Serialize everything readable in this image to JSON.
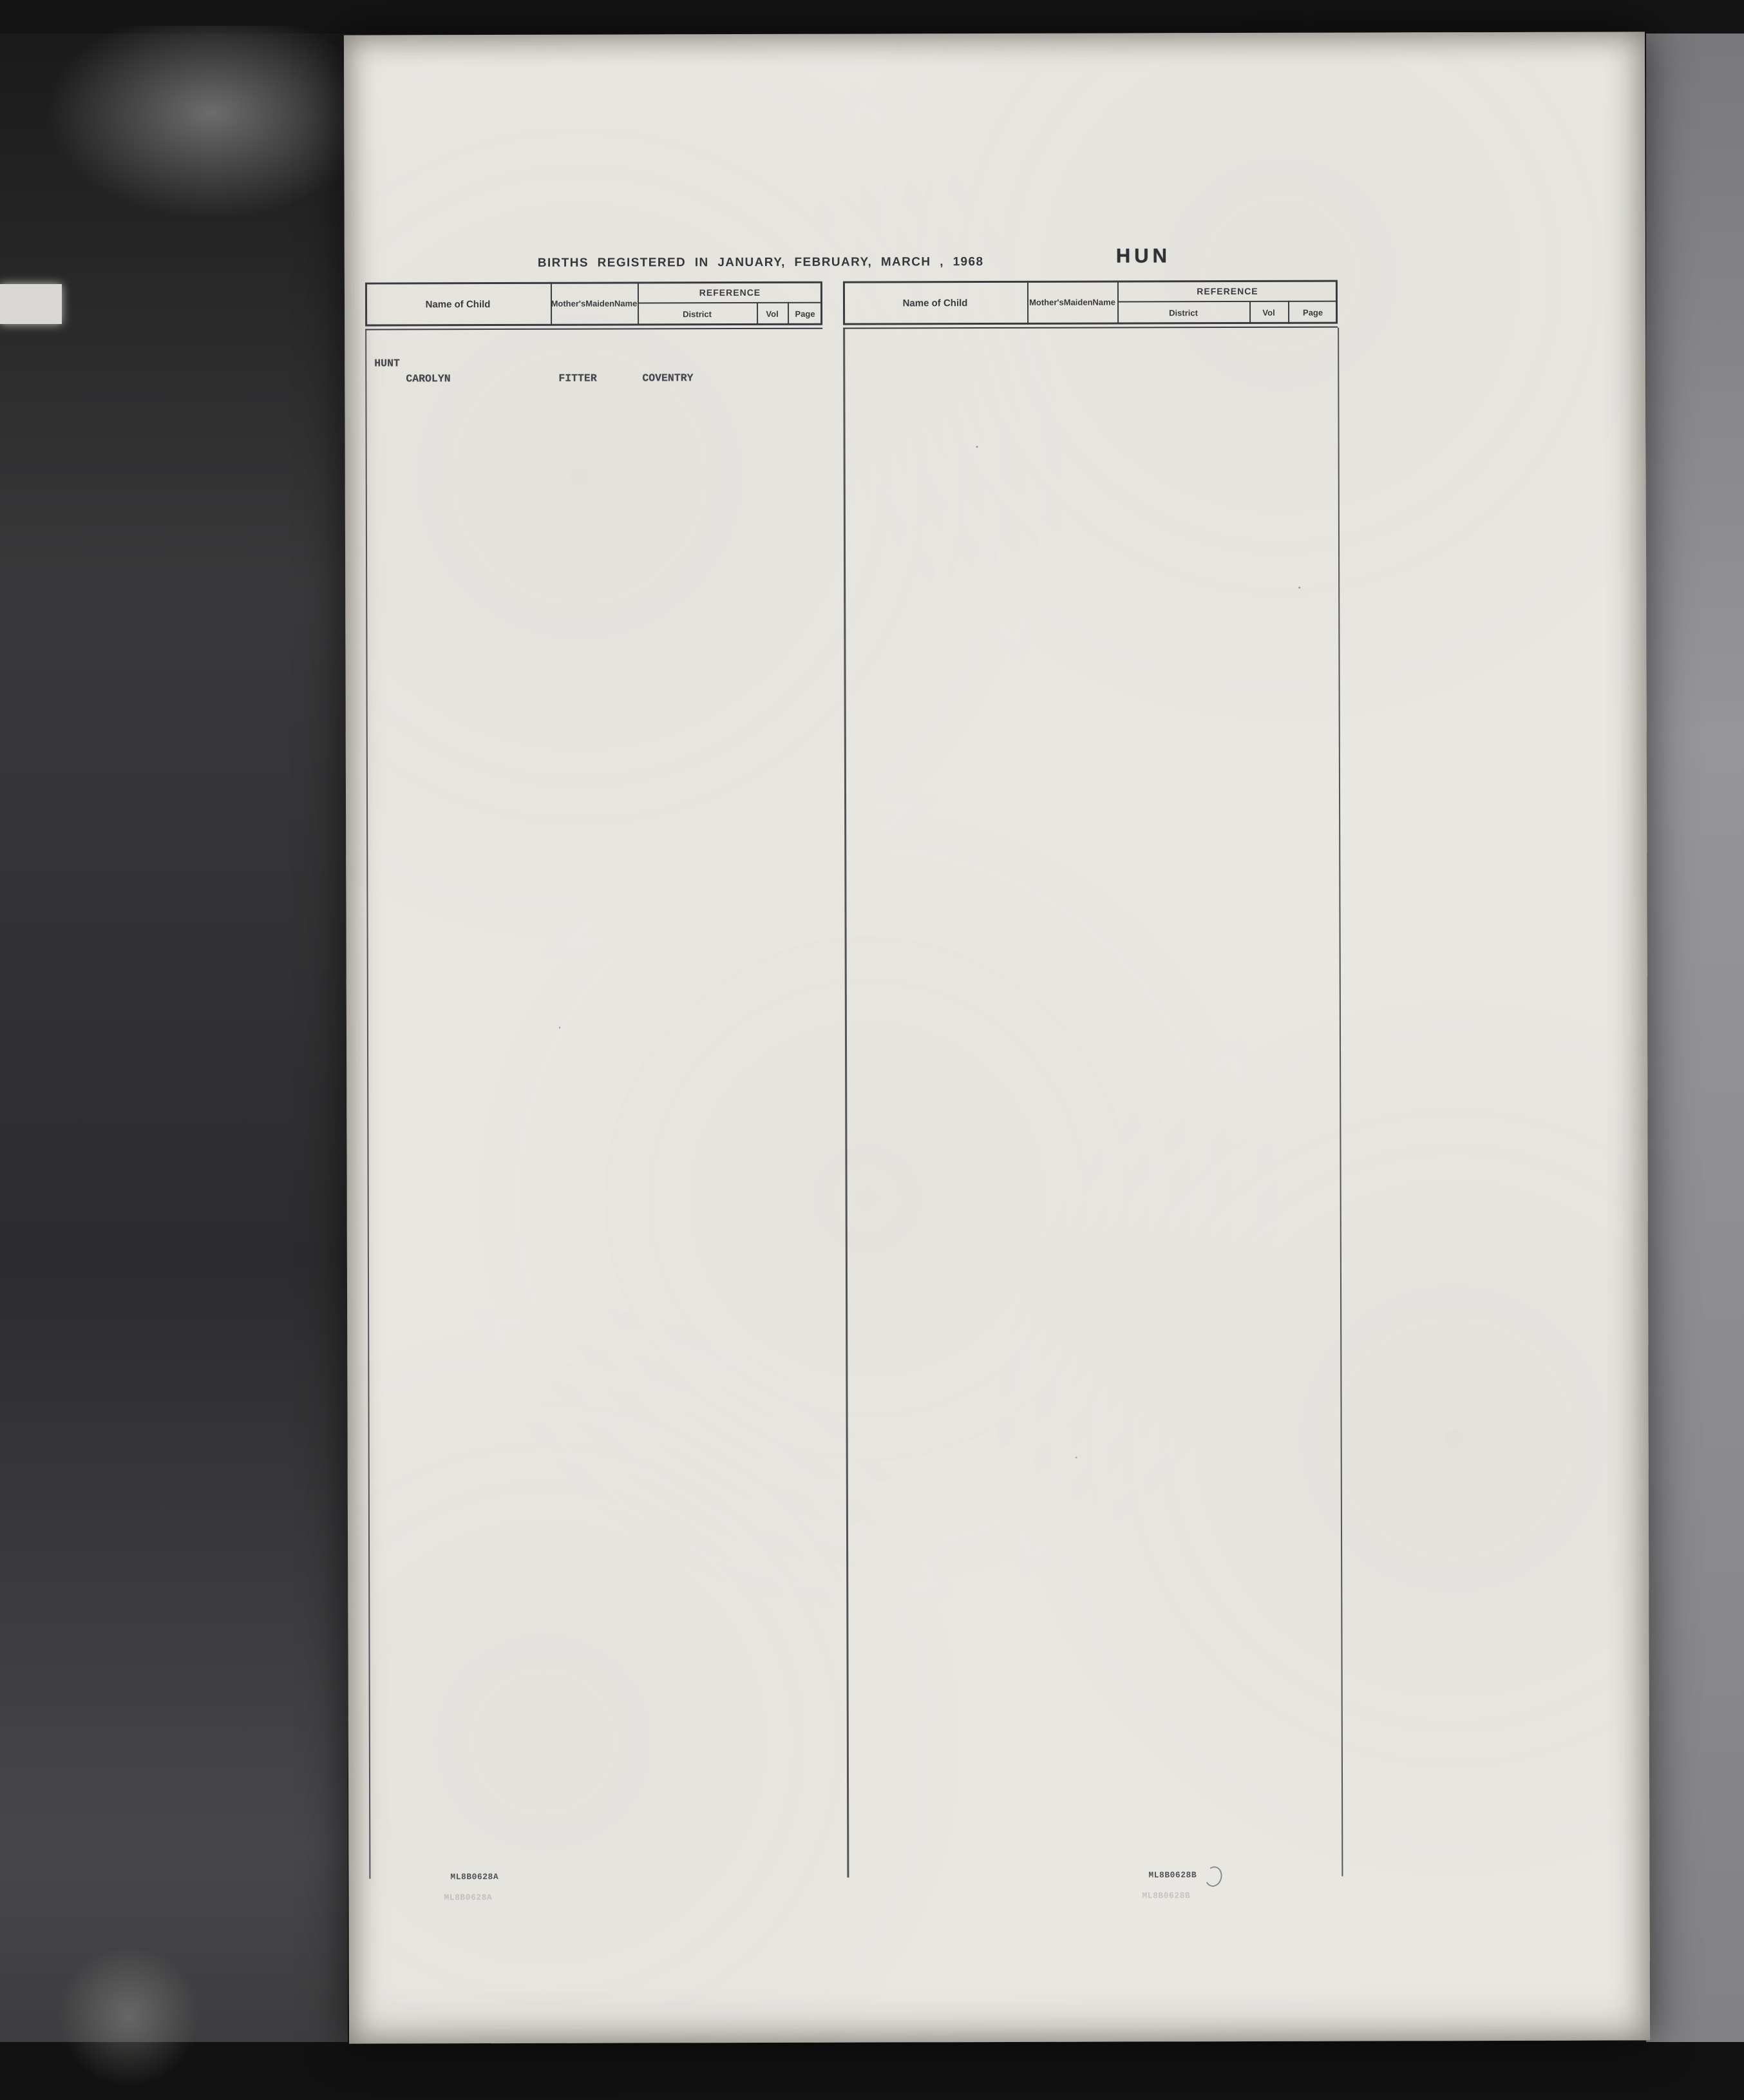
{
  "header": {
    "title": "BIRTHS REGISTERED IN JANUARY, FEBRUARY, MARCH , 1968",
    "section_code": "HUN",
    "col_name": "Name of Child",
    "col_mother_1": "Mother's",
    "col_mother_2": "Maiden",
    "col_mother_3": "Name",
    "col_reference": "REFERENCE",
    "col_district": "District",
    "col_vol": "Vol",
    "col_page": "Page"
  },
  "surname_left": "HUNT",
  "surname_right": "HUNT",
  "stamps": {
    "left": "ML8B0628A",
    "right": "ML8B0628B"
  },
  "footnotes_left": {
    "vol_note": "3c",
    "scribble": "372"
  },
  "left_groups": [
    [
      [
        "CAROLYN",
        "FITTER",
        "COVENTRY",
        "9C1344"
      ],
      [
        "CATHERINE ANN",
        "DIAMOND",
        "ROCHFORD",
        "4A1620"
      ],
      [
        "CATHERINE MARY",
        "TINDALL",
        "DON VALLEY",
        "2B 834"
      ],
      [
        "CELIA RUTH",
        "IVIN",
        "BEXLEY",
        "5A 334"
      ],
      [
        "CHERYL ANN",
        "CLEGG",
        "LEIGH",
        "10D  46"
      ],
      [
        "CHRISTINE MARGARET",
        "CADY",
        "THANET",
        "5F1042"
      ],
      [
        "CHRISTINE MARIE",
        "FOLAN",
        "BARTON",
        "10B 377"
      ],
      [
        "CHRISTOPHER CHARLES",
        "BENNETT",
        "WARRINGTON",
        "10F1062"
      ],
      [
        "CHRISTOPHER JOHN",
        "LAMONT",
        "WINCHESTER",
        "6B1345"
      ],
      [
        "CLAIR",
        "PONIFACE",
        "EASTBOURNE",
        "5H 346"
      ]
    ],
    [
      [
        "CLAIPE LOUISE",
        "MORKOT",
        "SWINDON",
        "7C1093"
      ],
      [
        "CLARE ROSEMARY",
        "YALLUP",
        "NUNEATON",
        "9C1744"
      ],
      [
        "CLIVE CHARLES",
        "HUNT",
        "NOTTINGHAM",
        "3C 707"
      ],
      [
        "COLETTE AISLING",
        "O'CONNOR",
        "MERTON",
        "5D 580S"
      ],
      [
        "COLIN DAVID",
        "RANDALL",
        "NEWHAM",
        "5E 900"
      ],
      [
        "DAREN STEPHEN",
        "ROBERTS",
        "MERIDEN",
        "9C1660"
      ],
      [
        "DARREN",
        "TURNER",
        "DUDLEY",
        "9B 332"
      ],
      [
        "DARREN ANDREW",
        "DANCE",
        "HOUNSLOW",
        "5C 669"
      ],
      [
        "DARREN GEOFFREY",
        "BUTTERWORTH",
        "WORCESTER",
        "9D 411"
      ],
      [
        "DARREN WILLIAM",
        "AYRE",
        "PORTSMOUTH",
        "6B 726"
      ]
    ],
    [
      [
        "DAVID",
        "COURTNEY",
        "S NEWINGTON",
        "5E 281"
      ],
      [
        "DAVID",
        "CANIELLS",
        "NORTHAMPTON",
        "3B1037"
      ],
      [
        "DAVID",
        "REYNOLDS",
        "LEICESTER",
        "3A 955"
      ],
      [
        "DAVID GAVIN",
        "SHAW",
        "NEWMARKET",
        "4B1841"
      ],
      [
        "DAVID LESLIE",
        "RUTTER",
        "BUCKROSE",
        "2A  65"
      ],
      [
        "DAVID PAUL",
        "GAUNT",
        "BRISTOL",
        "7B 484"
      ],
      [
        "DAVID STEWART",
        "DUDDLE",
        "INCE",
        "10C 611"
      ],
      [
        "DAVID THOMAS",
        "VENNING",
        "TAVISTOCK",
        "7A 941"
      ],
      [
        "DAVID WILLIAM",
        "SENNETT",
        "SURREY S W",
        "5G 669"
      ],
      [
        "DAWN MARY",
        "MEPHAM",
        "LEICESTER C",
        "3A 780"
      ]
    ],
    [
      [
        "DEAN THOMAS",
        "FIELDS",
        "BIRMINGHAM",
        "9C 297"
      ],
      [
        "DEBBIE JANE",
        "HARKNESS",
        "BIGGLESWADE",
        "4A 186"
      ],
      [
        "DEBORAH IRENE",
        "WHEELER",
        "BARKING",
        "5A 104"
      ],
      [
        "DEBORAH LOUISE",
        "HOPLEY",
        "COVENTRY",
        "9C1366"
      ],
      [
        "DEBORAH MARGARET",
        "ROBERTS",
        "NEWPORT",
        "8C 528"
      ],
      [
        "DEBRA",
        "JOHNSON",
        "STOKE/T",
        "9B 746"
      ],
      [
        "DELLA JANE",
        "JONES",
        "OSWESTRY",
        "9A 200"
      ],
      [
        "DENNIS RICHARD",
        "COOK",
        "HAMMERSMITH",
        "5B1044"
      ],
      [
        "DIANE EVA N.M.",
        "HOUGHTON",
        "BIRMINGHAM",
        "9C 452"
      ],
      [
        "DIANNA DAPHNE",
        "HUNT",
        "HACKNEY",
        "5B 588"
      ]
    ],
    [
      [
        "DONNA LOUISE",
        "EVANS",
        "AMOUNDERNESS",
        "10B  84"
      ],
      [
        "DONNA LOUISE",
        "GALLOWAY",
        "HULL",
        "2A 632"
      ],
      [
        "DONNA MARIE",
        "HUNT",
        "BEDFORD",
        "4A 146"
      ],
      [
        "EDWARD JAMES",
        "MURRAY",
        "ROMSEY",
        "6B1069"
      ],
      [
        "ELIZABETH ANN",
        "HEALEY",
        "CHELMSFORD",
        "4A 971"
      ],
      [
        "EMMA LOUISE",
        "SIMS",
        "LAMBETH",
        "5D 271"
      ],
      [
        "FRANCIS HENRY",
        "MARSHALL",
        "W CHESHIRE",
        "10A1038"
      ],
      [
        "GAIL MARIE",
        "BROWN",
        "KINGS L",
        "4B 341S"
      ],
      [
        "GARETH LEONARD",
        "HOLLIDAY",
        "WANDSWORTH",
        "5E 705"
      ],
      [
        "GARY ALAN",
        "FINDLEY",
        "MANCHESTER",
        "10E  11"
      ]
    ],
    [
      [
        "GARY GEOFFREY",
        "GILL",
        "W BROMWICH",
        "9B1375"
      ],
      [
        "GARY RICHARD",
        "WAIN",
        "PLYMOUTH",
        "7A 927"
      ],
      [
        "GARY ROBERT",
        "DANIELS",
        "BARTON",
        "10B 501"
      ],
      [
        "GAYNOR",
        "HOLDSWORTH",
        "BRADFORD",
        "2B 262"
      ],
      [
        "GERALDINE MARY",
        "DAVENPORT",
        "BROMLEY",
        "5A 833"
      ],
      [
        "GILLIAN",
        "BOLTON",
        "FYLDE",
        "10C 364"
      ],
      [
        "GILLIAN",
        "SMITH",
        "HEYWOOD",
        "10C 510"
      ],
      [
        "GILLIAN ANN",
        "GLOVER",
        "ST.HELENS",
        "10F 642"
      ],
      [
        "GINNETTE MARIE",
        "FREEMAN",
        "NEWCASTLE/L",
        "9B 531"
      ],
      [
        "GLENN STEWART",
        "ROBERTS",
        "HOLDERNESS",
        "2A  87"
      ]
    ],
    [
      [
        "GLORIA SUSANNAH",
        "WAUGH",
        "ISLINGTON",
        "5C1030"
      ],
      [
        "GRAHAM KARL",
        "GOODYEAR",
        "BRENTWOOD",
        "4A 865"
      ],
      [
        "HELEN ROBERTS",
        "GARNHAM",
        "ETON",
        "6A 829"
      ],
      [
        "HELENA ELIZABETH",
        "CARROLL",
        "WALLINGFORD",
        "6A 380"
      ],
      [
        "IAN MALCOLM",
        "COX",
        "TONBRIDGE",
        "5F1288"
      ],
      [
        "IAN PHILIP",
        "GEORGE",
        "ALDRIDGE",
        "9B   7"
      ],
      [
        "IAN RICHARD",
        "FLETCHER",
        "MANCHESTER",
        "10E 260"
      ],
      [
        "IAN RONALD",
        "ATTARD",
        "CAMBERWELL",
        "5A1188"
      ],
      [
        "JAMES",
        "HUNT",
        "LIVERPOOL N",
        "10D 641"
      ],
      [
        "JAMES ANTHONY S.",
        "RYAN",
        "BRENT",
        "5A 697"
      ]
    ],
    [
      [
        "JAMES JOHN",
        "READY",
        "OLDHAM",
        "10F  33",
        {
          "mark": "^"
        }
      ],
      [
        "JAMIE",
        "JONES",
        "NORTHAMPTON",
        "3B1117"
      ],
      [
        "JANE",
        "BLOMFIELD",
        "CHELSEA",
        "5A1257"
      ],
      [
        "JANE LOUISE",
        "HUNT",
        "CHELSEA",
        "5A1264"
      ],
      [
        "JANICE PATRICIA",
        "DOCHERTY",
        "NEWPORT",
        "8C 650"
      ],
      [
        "JASON DAVID",
        "WESTON",
        "LEWISHAM",
        "5D 643"
      ],
      [
        "JENNIFER JEAN",
        "JACQUES",
        "STEPNEY",
        "5E  98"
      ],
      [
        "JENNIFER MARGARET",
        "CONWAY",
        "SURREY N W",
        "5G 228"
      ],
      [
        "JEREMY GEORGE",
        "LESSEY",
        "YEOVIL",
        "7C 749"
      ],
      [
        "JEREMY PAUL",
        "MURDOCH",
        "GLOUCESTER C",
        "7B 740"
      ]
    ],
    [
      [
        "JEREMY VALENTINE",
        "TAMBURRINI",
        "ETON",
        "6A 879"
      ],
      [
        "JOANNE LOUISE",
        "WINFIELD",
        "LEICESTER C",
        "3A 738"
      ],
      [
        "JOANNE MARCIA",
        "MILLER",
        "BEDWELLTY",
        "8C 226"
      ],
      [
        "JOANNE MARIE",
        "HUNT",
        "HACKNEY",
        "5B 551"
      ],
      [
        "JOHN ANDREW",
        "SPULLEN",
        "CAMBRIDGE",
        "4A 644"
      ],
      [
        "JOHN HENRY W.",
        "JEFFREY",
        "BEXLEY",
        "5A 273"
      ],
      [
        "JONATHAN JAMES",
        "LECOCQ",
        "WARWICK",
        "9C2362"
      ],
      [
        "JONATHAN JOSEPH",
        "STEBBENS",
        "LAMBETH",
        "5D 314"
      ],
      [
        "JONATHAN PATRICK",
        "MILLER",
        "BATH",
        "7C 337"
      ],
      [
        "JOSEPH ELAND",
        "BLADES",
        "DURHAM E",
        "1A 509"
      ],
      [
        "JULIA KATHERINE",
        "HINKS",
        "TROWBRIDGE",
        "7C1173"
      ],
      [
        "JULIE ANN",
        "SMITH",
        "DERBY",
        "3A",
        {
          "blot": true
        }
      ],
      [
        "JAMES PATRICK",
        "LEWIS",
        "NOTTINGHAM",
        "",
        {
          "hw": true,
          "mark": "1-"
        }
      ]
    ]
  ],
  "right_groups": [
    [
      [
        "JULIE ANNE",
        "SPINNEY",
        "POOLE",
        "7C  89"
      ],
      [
        "JULIE HELEN",
        "SMITH",
        "GOSPORT",
        "6B 529"
      ],
      [
        "JULIE LOUISE",
        "FRUEN",
        "SOUTHAMPTON",
        "6B1194"
      ],
      [
        "JULIE MARIE",
        "BURDEKIN",
        "ABINGDON",
        "6A  12"
      ],
      [
        "JUSTIN",
        "HUNT",
        "LIVERPOOL N",
        "10D 641"
      ],
      [
        "KAREN",
        "PARTINGTON",
        "HEYWOOD",
        "10C 499"
      ],
      [
        "KATRINA",
        "HARVEY",
        "SURREY S W",
        "5G 662"
      ],
      [
        "KEVIN ANDREW",
        "GREENAWAY",
        "EXETER",
        "7A 492"
      ],
      [
        "KEVIN ANDREW",
        "HUNT",
        "WOLVERHAMPTON",
        "9B1729"
      ],
      [
        "KEVIN TONY",
        "GARDINER",
        "STROUD",
        "7B 955"
      ]
    ],
    [
      [
        "KIMBERLEY JANE",
        "HUNT",
        "LEICESTER C",
        "3A 775"
      ],
      [
        "LAURA ELIZABETH",
        "DAY",
        "MIDDLESBRO",
        "1B1169"
      ],
      [
        "LAURA JANE",
        "LINNELL",
        "NORTHAMPTON",
        "3B1066"
      ],
      [
        "LEAH",
        "HUNT",
        "NEWHAM",
        "5E 963"
      ],
      [
        "LEON CARWARDINE",
        "PURCHASE",
        "BRISTOL",
        "7B  68"
      ],
      [
        "LESLEY ANNE",
        "SMY",
        "NEWHAM",
        "5E 899"
      ],
      [
        "LESLEY KAREN",
        "KEAN",
        "BARTON",
        "10B 446",
        {
          "mark": "1-"
        }
      ],
      [
        "LISA",
        "FRIEND",
        "PONTYPOOL",
        "8C1045"
      ],
      [
        "LISA",
        "ROSE",
        "SOUTHWARK",
        "5E  73"
      ],
      [
        "LISA ANN",
        "WARDELL",
        "SOUTHAMPTON",
        "6B1273"
      ]
    ],
    [
      [
        "LISA BONNIE",
        "LIGHT",
        "GOSPORT",
        "6B 512"
      ],
      [
        "LISA DIANE",
        "WROATH",
        "LICHFIELD",
        "9B 421"
      ],
      [
        "LISA HELEN",
        "NEENAN",
        "W BROMWICH",
        "9B1253"
      ],
      [
        "LISA JANE",
        "WATLING",
        "THURROCK",
        "4A1878"
      ],
      [
        "LISA MELANIE",
        "BROOKES",
        "HILLINGDON",
        "5C 566"
      ],
      [
        "LORRAINE ELIZABETH",
        "PATRICK",
        "MAIDSTONE",
        "5F ",
        {
          "strike": "934",
          "note": "11243/5",
          "ndx": 6,
          "nsize": 21
        }
      ],
      [
        "LOUISE CHRISTINE M.",
        "DENT",
        "CHESTERFIELD",
        "3A 139"
      ],
      [
        "LUCY DAILY",
        "ADAMS",
        "STOKE/T",
        "9B 766"
      ],
      [
        "LYNDA MARGARET E.",
        "RITCHIE",
        "KETTERING",
        "3B 907"
      ],
      [
        "MANDY",
        "MITCHELL",
        "SOUTHAMPTON",
        "6B1074"
      ]
    ],
    [
      [
        "MANDY CAROLINE",
        "LONGTON",
        "ALDERSHOT",
        "6B  28"
      ],
      [
        "MARC GIANCARLO",
        "CASSE-PIERRE",
        "KENSINGTON",
        "5C1347"
      ],
      [
        "MARIE ELIZABETH",
        "WATTON",
        "WARLEY E",
        "9D 310"
      ],
      [
        "MARK ANDREW",
        "WHITE",
        "CANTERBURY",
        "5F 139"
      ],
      [
        "MARK CHRISTOPHER",
        "KRYZA",
        "BEDFORD",
        "4A ",
        {
          "strike": "648",
          "note": "8619/5",
          "ndx": -66,
          "nsize": 27
        }
      ],
      [
        "MARK DAVID E.",
        "MULHOLLAND",
        "EALING",
        "5B 144"
      ],
      [
        "MARK JOHN",
        "GORDON",
        "NEWHAM",
        "5E 996"
      ],
      [
        "MARK JONATHAN",
        "HOPKINS",
        "WINCANTON",
        "7C 738"
      ],
      [
        "MARK JONATHAN",
        "SIDES",
        "COVENTRY",
        "9C1470"
      ],
      [
        "MARK PHILIP",
        "CESSFORD",
        "MIDDLESBRO",
        "1B1154"
      ]
    ],
    [
      [
        "MARTIN JON",
        "MOLONEY",
        "BIRMINGHAM",
        "9C1024"
      ],
      [
        "MARTIN RAYMOND F.",
        "BURT",
        "CUCKFIELD",
        "5H 247"
      ],
      [
        "MARTIN ROLAND",
        "KING",
        "SALISBURY",
        "7C 967"
      ],
      [
        "MAUREEN LYNNE",
        "WOOD",
        "CHESTERFIELD",
        "3A 164"
      ],
      [
        "MAXINE JULIE",
        "MCCARTHY",
        "COVENTRY",
        "9C1306"
      ],
      [
        "MELANIE",
        "FARTHING",
        "MIDDLESBRO",
        "1B1077"
      ],
      [
        "MELANIE SARA",
        "KNOWLES",
        "WORCESTER",
        "9D 395"
      ],
      [
        "MICHAEL ALAN",
        "KELLY",
        "GLOUCESTER C",
        "7B 701"
      ],
      [
        "MICHAEL DAVID",
        "WRIGHT",
        "NORWICH O",
        "4B1430"
      ],
      [
        "MICHAEL IAN",
        "DIXON",
        "DARWEN",
        "10C 156"
      ]
    ],
    [
      [
        "MICHAEL WAYNE",
        "CANTERBURY",
        "WEYMOUTH",
        "7C 200"
      ],
      [
        "MICHELLE",
        "CALDECOURT",
        "CANTERBURY",
        "5F 126"
      ],
      [
        "MICHELLE",
        "HUYTON",
        "SOUTHPORT",
        "10F 937"
      ],
      [
        "MICHELLE",
        "MABBLEY",
        "CANNOCK",
        "9B 190"
      ],
      [
        "MICHELLE DAWN",
        "CIVELL",
        "IPSWICH",
        "4B1638"
      ],
      [
        "NEIL ANDREW",
        "O'HARA",
        "DERBY",
        "3A 590",
        {
          "mark": "1."
        }
      ],
      [
        "NEIL BRADLEY",
        "ILES",
        "BRISTOL",
        "7B  72"
      ],
      [
        "NEWTON IVANHOE J.",
        "HUNT",
        "MANCHESTER",
        "10E 435"
      ],
      [
        "NICHOLAS",
        "EDWARDS",
        "BURY ST E",
        "4B1759"
      ],
      [
        "NICOLA",
        "OGBORNE",
        "WESTON",
        "7C 650"
      ]
    ],
    [
      [
        "NICOLA ANNE",
        "GOODALL",
        "HYDE",
        "10A 519"
      ],
      [
        "NICOLAS GARFIELD T.",
        "THOMASON",
        "MANCHESTER",
        "10E 658"
      ],
      [
        "NIGEL JOHN",
        "HALL",
        "NORWICH",
        "4B1305"
      ],
      [
        "NIGEL MARK J.",
        "CAREY",
        "HAVERING",
        "5C  66"
      ],
      [
        "PATRICIA ANGELIQUE C.",
        "HAYNES",
        "BRISTOL",
        "7B 321"
      ],
      [
        "PAUL ALLEN",
        "HERBERT",
        "WANDSWORTH",
        "5E 733"
      ],
      [
        "PAUL ANTHONY",
        "HOLMES",
        "EXETER",
        "7A 470"
      ],
      [
        "PAUL EDWARD",
        "JENKINSON",
        "HOLDERNESS",
        "2A 185"
      ],
      [
        "PAUL FENTON",
        "LUTLEY",
        "BUCKLOW",
        "10A 166"
      ],
      [
        "PAUL HARWOOD",
        "EVANS",
        "OXFORD",
        "6B1894"
      ]
    ],
    [
      [
        "PAUL JAMES",
        "MISSENDEN",
        "BARKING",
        "5A 116"
      ],
      [
        "PAUL NICHOLAS",
        "NILSEN",
        "CARDIFF",
        "8B 383"
      ],
      [
        "PAULA",
        "NICHOLS",
        "IPSWICH",
        "4B1554"
      ],
      [
        "PAULA ELIZABETH",
        "TANSUR",
        "WELLINGBORO",
        "3B1160"
      ],
      [
        "PAULINE",
        "BAILEY",
        "MIDDLESBRO",
        "1B1171"
      ],
      [
        "PETER",
        "NICKSON",
        "PRESCOT",
        "10F 291"
      ],
      [
        "PETER",
        "WALL",
        "HAVERING",
        "5C 171"
      ],
      [
        "PETER GRAHAM",
        "CHOWN",
        "STURMINSTER",
        "7C 151"
      ],
      [
        "PETER JOHN",
        "CONWAY",
        "WARWICK",
        "9C2376"
      ],
      [
        "PHILIP",
        "HUNT",
        "HULL",
        "2A 648"
      ]
    ],
    [
      [
        "PHILIP IAN",
        "MAYER",
        "ST.HELENS",
        "10F 618"
      ],
      [
        "PHILIP JAMES",
        "WEST",
        "BRADFORD",
        "2B 300"
      ],
      [
        "PHILIP MICHAEL",
        "CHAPMAN",
        "W GLAMORGAN",
        "3B2911"
      ],
      [
        "PHILIPPA JANE",
        "RAMSEY",
        "ELY",
        "4A 663"
      ],
      [
        "PHILLIPA ANN",
        "LLOYD",
        "SUTTON COLDF",
        "9C2207"
      ],
      [
        "RACHAEL",
        "SHAW",
        "FARNWORTH",
        "10C 197"
      ],
      [
        "REBECCA",
        "GOULD",
        "EALING",
        "5B  13"
      ],
      [
        "REBECCA PETRINA",
        "TUBES",
        "PORTSMOUTH",
        "6B 917"
      ],
      [
        "RICHARD ANTHONY",
        "HUNT",
        "DERBY",
        "3A 381"
      ],
      [
        "RICKY",
        "HAYASHI",
        "LUTON",
        "4A 326"
      ],
      [
        "ROBERT ANDREW",
        "BENNETT",
        "LUTON",
        "4A 343"
      ],
      [
        "ROBERT BARRY",
        "CROOK",
        "WALSALL",
        "9B1043"
      ],
      [
        "NATALIE CLAIRE M.",
        "WILLIAMS",
        "ST ASAPH.",
        "8A 870",
        {
          "hw": true,
          "mark": "1."
        }
      ]
    ],
    [
      [
        "LINDA MARGARET. E.",
        "RITCHIE.",
        "KETTERING.",
        "3B.10102/S.",
        {
          "hw": true,
          "mark": "2."
        }
      ]
    ]
  ]
}
